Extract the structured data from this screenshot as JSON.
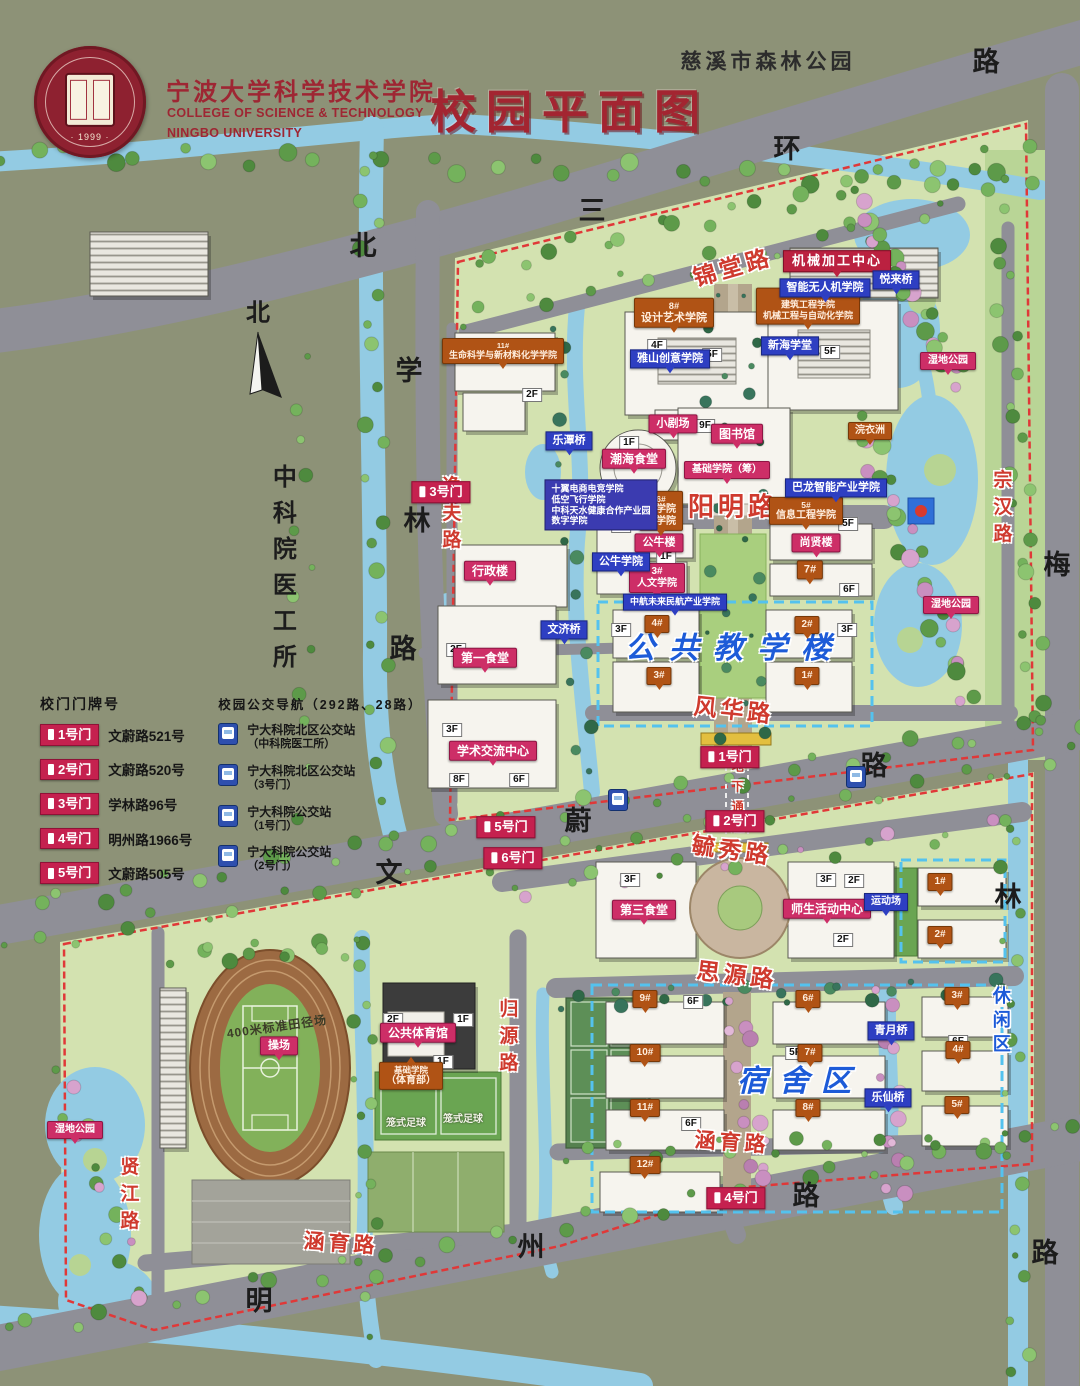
{
  "header": {
    "school_cn": "宁波大学科学技术学院",
    "school_en1": "COLLEGE OF SCIENCE & TECHNOLOGY",
    "school_en2": "NINGBO UNIVERSITY",
    "title": "校园平面图",
    "park": "慈溪市森林公园",
    "logo_year": "· 1999 ·"
  },
  "legend": {
    "gates_title": "校门门牌号",
    "gates": [
      {
        "tag": "1号门",
        "addr": "文蔚路521号"
      },
      {
        "tag": "2号门",
        "addr": "文蔚路520号"
      },
      {
        "tag": "3号门",
        "addr": "学林路96号"
      },
      {
        "tag": "4号门",
        "addr": "明州路1966号"
      },
      {
        "tag": "5号门",
        "addr": "文蔚路505号"
      }
    ],
    "bus_title": "校园公交导航（292路、28路）",
    "bus_stops": [
      {
        "line1": "宁大科院北区公交站",
        "line2": "（中科院医工所）"
      },
      {
        "line1": "宁大科院北区公交站",
        "line2": "（3号门）"
      },
      {
        "line1": "宁大科院公交站",
        "line2": "（1号门）"
      },
      {
        "line1": "宁大科院公交站",
        "line2": "（2号门）"
      }
    ]
  },
  "colors": {
    "campus_green": "#d3e2b0",
    "water": "#93cbe3",
    "road_gray": "#8f8f97",
    "tag_pink": "#cd2e67",
    "tag_orange": "#b05315",
    "tag_blue": "#2e3fc2",
    "tag_gate": "#c5214f",
    "boundary_red": "#e03838",
    "zone_blue": "#1d5bd8"
  },
  "labels": [
    {
      "t": "北",
      "x": 363,
      "y": 246,
      "s": "black"
    },
    {
      "t": "三",
      "x": 592,
      "y": 211,
      "s": "black"
    },
    {
      "t": "环",
      "x": 787,
      "y": 149,
      "s": "black"
    },
    {
      "t": "路",
      "x": 986,
      "y": 62,
      "s": "black"
    },
    {
      "t": "学",
      "x": 409,
      "y": 371,
      "s": "black"
    },
    {
      "t": "林",
      "x": 417,
      "y": 521,
      "s": "black"
    },
    {
      "t": "路",
      "x": 403,
      "y": 649,
      "s": "black"
    },
    {
      "t": "文",
      "x": 389,
      "y": 873,
      "s": "black"
    },
    {
      "t": "蔚",
      "x": 578,
      "y": 821,
      "s": "black"
    },
    {
      "t": "路",
      "x": 874,
      "y": 766,
      "s": "black"
    },
    {
      "t": "明",
      "x": 259,
      "y": 1301,
      "s": "black"
    },
    {
      "t": "州",
      "x": 531,
      "y": 1247,
      "s": "black"
    },
    {
      "t": "路",
      "x": 806,
      "y": 1196,
      "s": "black"
    },
    {
      "t": "梅",
      "x": 1057,
      "y": 565,
      "s": "black"
    },
    {
      "t": "林",
      "x": 1008,
      "y": 897,
      "s": "black"
    },
    {
      "t": "路",
      "x": 1045,
      "y": 1253,
      "s": "black"
    },
    {
      "t": "北",
      "x": 258,
      "y": 314,
      "s": "black",
      "fs": 24,
      "n": "compass-north-label"
    },
    {
      "t": "中科院医工所",
      "x": 281,
      "y": 572,
      "s": "blackv",
      "fs": 24,
      "n": "institute-area-label"
    },
    {
      "t": "慈溪市森林公园",
      "x": 768,
      "y": 62,
      "s": "park",
      "n": "forest-park-label"
    },
    {
      "t": "锦堂路",
      "x": 733,
      "y": 268,
      "s": "road",
      "r": -16
    },
    {
      "t": "阳明路",
      "x": 733,
      "y": 507,
      "s": "road",
      "fs": 26
    },
    {
      "t": "风华路",
      "x": 734,
      "y": 711,
      "s": "road",
      "r": 6
    },
    {
      "t": "毓秀路",
      "x": 732,
      "y": 851,
      "s": "road",
      "r": 8
    },
    {
      "t": "思源路",
      "x": 737,
      "y": 976,
      "s": "road",
      "r": 7
    },
    {
      "t": "涵育路",
      "x": 732,
      "y": 1143,
      "s": "road",
      "r": 4,
      "fs": 21
    },
    {
      "t": "涵育路",
      "x": 341,
      "y": 1244,
      "s": "road",
      "r": 4,
      "fs": 21
    },
    {
      "t": "逸夫路",
      "x": 449,
      "y": 516,
      "s": "roadv",
      "fs": 19
    },
    {
      "t": "归源路",
      "x": 506,
      "y": 1039,
      "s": "roadv",
      "fs": 19
    },
    {
      "t": "贤江路",
      "x": 127,
      "y": 1197,
      "s": "roadv",
      "fs": 19
    },
    {
      "t": "宗汉路",
      "x": 1000,
      "y": 510,
      "s": "roadv",
      "fs": 19
    },
    {
      "t": "地下通道",
      "x": 737,
      "y": 800,
      "s": "roadv",
      "fs": 12,
      "n": "underpass-label"
    },
    {
      "t": "公共教学楼",
      "x": 735,
      "y": 649,
      "s": "zone",
      "fs": 30,
      "lsp": 14,
      "n": "zone-label-teaching"
    },
    {
      "t": "宿舍区",
      "x": 800,
      "y": 1082,
      "s": "zone",
      "fs": 30,
      "lsp": 12,
      "n": "zone-label-dormitory"
    },
    {
      "t": "休闲区",
      "x": 1000,
      "y": 1022,
      "s": "zonev",
      "fs": 18,
      "n": "zone-label-leisure"
    },
    {
      "t": "小剧场",
      "x": 673,
      "y": 424,
      "s": "pink",
      "fs": 11
    },
    {
      "t": "图书馆",
      "x": 737,
      "y": 434,
      "s": "pink"
    },
    {
      "t": "潮海食堂",
      "x": 634,
      "y": 459,
      "s": "pink"
    },
    {
      "t": "基础学院（筹）",
      "x": 727,
      "y": 470,
      "s": "pink",
      "fs": 10
    },
    {
      "t": "公牛楼",
      "x": 659,
      "y": 543,
      "s": "pink",
      "fs": 11
    },
    {
      "ls": [
        "3#",
        "人文学院"
      ],
      "x": 657,
      "y": 578,
      "s": "pink",
      "fs": 10
    },
    {
      "t": "行政楼",
      "x": 490,
      "y": 571,
      "s": "pink"
    },
    {
      "t": "第一食堂",
      "x": 485,
      "y": 658,
      "s": "pink"
    },
    {
      "t": "学术交流中心",
      "x": 493,
      "y": 751,
      "s": "pink"
    },
    {
      "t": "尚贤楼",
      "x": 816,
      "y": 543,
      "s": "pink",
      "fs": 11
    },
    {
      "t": "第三食堂",
      "x": 644,
      "y": 910,
      "s": "pink"
    },
    {
      "t": "师生活动中心",
      "x": 827,
      "y": 909,
      "s": "pink"
    },
    {
      "t": "公共体育馆",
      "x": 418,
      "y": 1033,
      "s": "pink"
    },
    {
      "t": "操场",
      "x": 279,
      "y": 1046,
      "s": "pink",
      "fs": 11
    },
    {
      "t": "湿地公园",
      "x": 948,
      "y": 361,
      "s": "pink",
      "fs": 10
    },
    {
      "t": "湿地公园",
      "x": 951,
      "y": 605,
      "s": "pink",
      "fs": 10
    },
    {
      "t": "湿地公园",
      "x": 75,
      "y": 1130,
      "s": "pink",
      "fs": 10
    },
    {
      "t": "机械加工中心",
      "x": 837,
      "y": 261,
      "s": "red"
    },
    {
      "t": "3号门",
      "x": 441,
      "y": 492,
      "s": "gate"
    },
    {
      "t": "1号门",
      "x": 730,
      "y": 757,
      "s": "gate"
    },
    {
      "t": "2号门",
      "x": 735,
      "y": 821,
      "s": "gate"
    },
    {
      "t": "5号门",
      "x": 506,
      "y": 827,
      "s": "gate"
    },
    {
      "t": "6号门",
      "x": 513,
      "y": 858,
      "s": "gate"
    },
    {
      "t": "4号门",
      "x": 736,
      "y": 1198,
      "s": "gate"
    },
    {
      "ls": [
        "8#",
        "设计艺术学院"
      ],
      "x": 674,
      "y": 313,
      "s": "orange"
    },
    {
      "ls": [
        "9#",
        "建筑工程学院",
        "机械工程与自动化学院"
      ],
      "x": 808,
      "y": 306,
      "s": "orange",
      "fs": 9
    },
    {
      "ls": [
        "11#",
        "生命科学与新材料化学学院"
      ],
      "x": 503,
      "y": 351,
      "s": "orange",
      "fs": 9
    },
    {
      "ls": [
        "6#",
        "商学院",
        "法学院"
      ],
      "x": 661,
      "y": 511,
      "s": "orange",
      "fs": 10
    },
    {
      "ls": [
        "5#",
        "信息工程学院"
      ],
      "x": 806,
      "y": 511,
      "s": "orange",
      "fs": 10
    },
    {
      "t": "7#",
      "x": 810,
      "y": 570,
      "s": "orange",
      "fs": 11
    },
    {
      "ls": [
        "基础学院",
        "（体育部）"
      ],
      "x": 411,
      "y": 1076,
      "s": "orange",
      "fs": 10,
      "pt": "up"
    },
    {
      "t": "浣衣洲",
      "x": 870,
      "y": 431,
      "s": "orange",
      "fs": 10
    },
    {
      "t": "4#",
      "x": 657,
      "y": 624,
      "s": "orange",
      "fs": 10
    },
    {
      "t": "3#",
      "x": 659,
      "y": 676,
      "s": "orange",
      "fs": 10
    },
    {
      "t": "2#",
      "x": 807,
      "y": 625,
      "s": "orange",
      "fs": 10
    },
    {
      "t": "1#",
      "x": 807,
      "y": 676,
      "s": "orange",
      "fs": 10
    },
    {
      "t": "9#",
      "x": 645,
      "y": 999,
      "s": "orange",
      "fs": 10
    },
    {
      "t": "10#",
      "x": 645,
      "y": 1053,
      "s": "orange",
      "fs": 10
    },
    {
      "t": "11#",
      "x": 645,
      "y": 1108,
      "s": "orange",
      "fs": 10
    },
    {
      "t": "12#",
      "x": 645,
      "y": 1165,
      "s": "orange",
      "fs": 10
    },
    {
      "t": "6#",
      "x": 808,
      "y": 999,
      "s": "orange",
      "fs": 10
    },
    {
      "t": "7#",
      "x": 810,
      "y": 1053,
      "s": "orange",
      "fs": 10
    },
    {
      "t": "8#",
      "x": 808,
      "y": 1108,
      "s": "orange",
      "fs": 10
    },
    {
      "t": "3#",
      "x": 957,
      "y": 996,
      "s": "orange",
      "fs": 10
    },
    {
      "t": "4#",
      "x": 958,
      "y": 1050,
      "s": "orange",
      "fs": 10
    },
    {
      "t": "5#",
      "x": 957,
      "y": 1105,
      "s": "orange",
      "fs": 10
    },
    {
      "t": "1#",
      "x": 940,
      "y": 882,
      "s": "orange",
      "fs": 10
    },
    {
      "t": "2#",
      "x": 940,
      "y": 935,
      "s": "orange",
      "fs": 10
    },
    {
      "t": "智能无人机学院",
      "x": 825,
      "y": 288,
      "s": "blue"
    },
    {
      "t": "悦来桥",
      "x": 896,
      "y": 280,
      "s": "blue",
      "n": "bridge-tag"
    },
    {
      "t": "雅山创意学院",
      "x": 670,
      "y": 359,
      "s": "blue"
    },
    {
      "t": "新海学堂",
      "x": 790,
      "y": 346,
      "s": "blue"
    },
    {
      "t": "巴龙智能产业学院",
      "x": 836,
      "y": 488,
      "s": "blue"
    },
    {
      "t": "公牛学院",
      "x": 621,
      "y": 562,
      "s": "blue"
    },
    {
      "t": "中航未来民航产业学院",
      "x": 675,
      "y": 602,
      "s": "blue",
      "fs": 9
    },
    {
      "t": "运动场",
      "x": 886,
      "y": 902,
      "s": "blue",
      "fs": 10
    },
    {
      "t": "乐潭桥",
      "x": 569,
      "y": 441,
      "s": "blue",
      "n": "bridge-tag"
    },
    {
      "t": "文济桥",
      "x": 564,
      "y": 630,
      "s": "blue",
      "n": "bridge-tag"
    },
    {
      "t": "青月桥",
      "x": 891,
      "y": 1031,
      "s": "blue",
      "n": "bridge-tag"
    },
    {
      "t": "乐仙桥",
      "x": 888,
      "y": 1098,
      "s": "blue",
      "n": "bridge-tag"
    },
    {
      "ls": [
        "十翼电商电竞学院",
        "低空飞行学院",
        "中科天水健康合作产业园",
        "数字学院"
      ],
      "x": 601,
      "y": 505,
      "s": "bluebox",
      "n": "industry-college-list"
    },
    {
      "t": "2F",
      "x": 532,
      "y": 395,
      "s": "floor"
    },
    {
      "t": "4F",
      "x": 657,
      "y": 346,
      "s": "floor"
    },
    {
      "t": "5F",
      "x": 712,
      "y": 355,
      "s": "floor"
    },
    {
      "t": "5F",
      "x": 830,
      "y": 352,
      "s": "floor"
    },
    {
      "t": "9F",
      "x": 705,
      "y": 426,
      "s": "floor"
    },
    {
      "t": "1F",
      "x": 629,
      "y": 443,
      "s": "floor"
    },
    {
      "t": "5F",
      "x": 621,
      "y": 526,
      "s": "floor"
    },
    {
      "t": "1F",
      "x": 666,
      "y": 557,
      "s": "floor"
    },
    {
      "t": "5F",
      "x": 848,
      "y": 524,
      "s": "floor"
    },
    {
      "t": "6F",
      "x": 849,
      "y": 590,
      "s": "floor"
    },
    {
      "t": "3F",
      "x": 621,
      "y": 630,
      "s": "floor"
    },
    {
      "t": "3F",
      "x": 847,
      "y": 630,
      "s": "floor"
    },
    {
      "t": "2F",
      "x": 456,
      "y": 650,
      "s": "floor"
    },
    {
      "t": "3F",
      "x": 452,
      "y": 730,
      "s": "floor"
    },
    {
      "t": "8F",
      "x": 459,
      "y": 780,
      "s": "floor"
    },
    {
      "t": "6F",
      "x": 519,
      "y": 780,
      "s": "floor"
    },
    {
      "t": "3F",
      "x": 630,
      "y": 880,
      "s": "floor"
    },
    {
      "t": "3F",
      "x": 826,
      "y": 880,
      "s": "floor"
    },
    {
      "t": "2F",
      "x": 854,
      "y": 881,
      "s": "floor"
    },
    {
      "t": "2F",
      "x": 843,
      "y": 940,
      "s": "floor"
    },
    {
      "t": "2F",
      "x": 393,
      "y": 1020,
      "s": "floor"
    },
    {
      "t": "1F",
      "x": 463,
      "y": 1020,
      "s": "floor"
    },
    {
      "t": "1F",
      "x": 443,
      "y": 1062,
      "s": "floor"
    },
    {
      "t": "6F",
      "x": 693,
      "y": 1002,
      "s": "floor"
    },
    {
      "t": "6F",
      "x": 691,
      "y": 1124,
      "s": "floor"
    },
    {
      "t": "5F",
      "x": 795,
      "y": 1053,
      "s": "floor"
    },
    {
      "t": "6F",
      "x": 958,
      "y": 1042,
      "s": "floor"
    },
    {
      "t": "400米标准田径场",
      "x": 277,
      "y": 1027,
      "s": "note",
      "r": -8
    },
    {
      "t": "笼式足球",
      "x": 406,
      "y": 1124,
      "s": "wnote"
    },
    {
      "t": "笼式足球",
      "x": 463,
      "y": 1120,
      "s": "wnote"
    },
    {
      "s": "bus",
      "x": 618,
      "y": 800,
      "n": "bus-stop-icon"
    },
    {
      "s": "bus",
      "x": 856,
      "y": 777,
      "n": "bus-stop-icon"
    }
  ]
}
